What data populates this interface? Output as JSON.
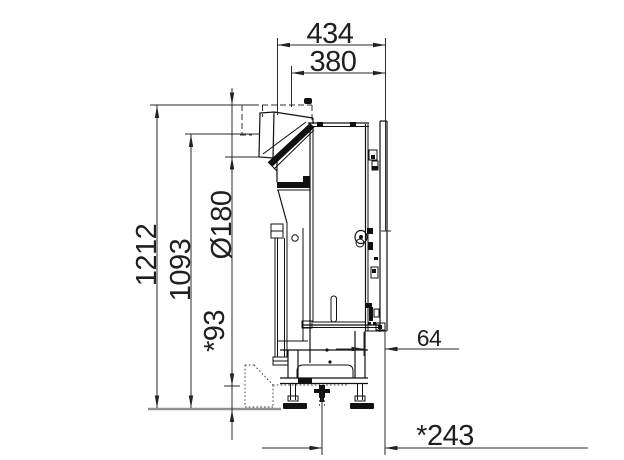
{
  "drawing": {
    "description": "Side-view dimensional drawing of floor-standing machine",
    "dims": {
      "top_outer": "434",
      "top_inner": "380",
      "height_total": "1212",
      "height_upper": "1093",
      "diameter": "Ø180",
      "foot_clearance": "*93",
      "rear_gap": "64",
      "bottom_offset": "*243"
    }
  }
}
